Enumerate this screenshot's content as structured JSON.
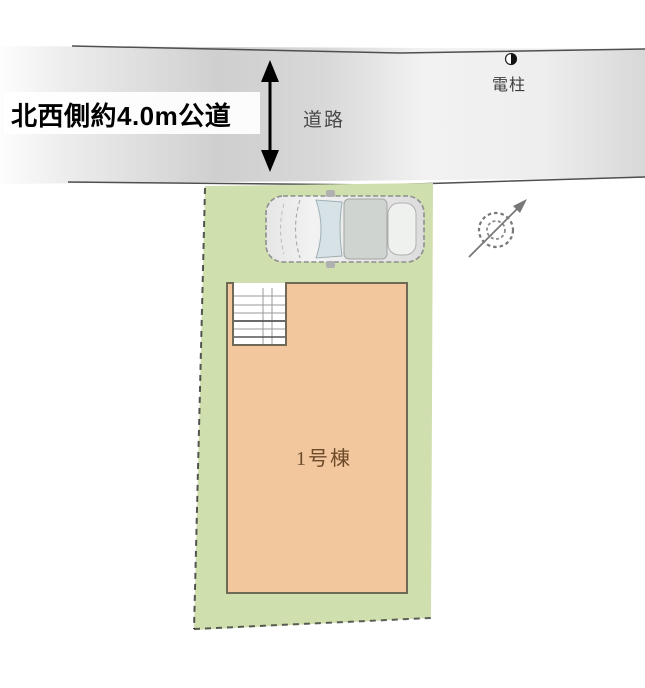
{
  "diagram": {
    "type": "real-estate-site-plan",
    "labels": {
      "road_side": "北西側約4.0m公道",
      "road": "道路",
      "utility_pole": "電柱",
      "building": "1号棟"
    },
    "annotations": {
      "road_width_note": "約4.0m",
      "road_direction": "北西側"
    },
    "icons": {
      "north_compass": "north-arrow-compass",
      "car": "car-top-view",
      "utility_pole_symbol": "half-filled-circle-pole-marker",
      "road_width_arrow": "vertical-double-arrow",
      "stairs": "stair-grid"
    },
    "colors": {
      "background": "#ffffff",
      "road_fill": "#d4d4d4",
      "road_edge": "#4f4f4f",
      "plot_fill": "#cfdfad",
      "building_fill": "#f2c79e",
      "building_stroke": "#6f6a58",
      "stair_line": "#9a9a9a",
      "stair_line_dark": "#555555",
      "car_body": "#dedede",
      "car_windshield": "#d6e2e6",
      "car_roof": "#d0d4d0",
      "compass_stroke": "#787878",
      "arrow_color": "#000000",
      "boundary_dash": "#2e2e2e",
      "building_label_color": "#6b4a2a",
      "road_label_color": "#4a4a4a"
    }
  }
}
